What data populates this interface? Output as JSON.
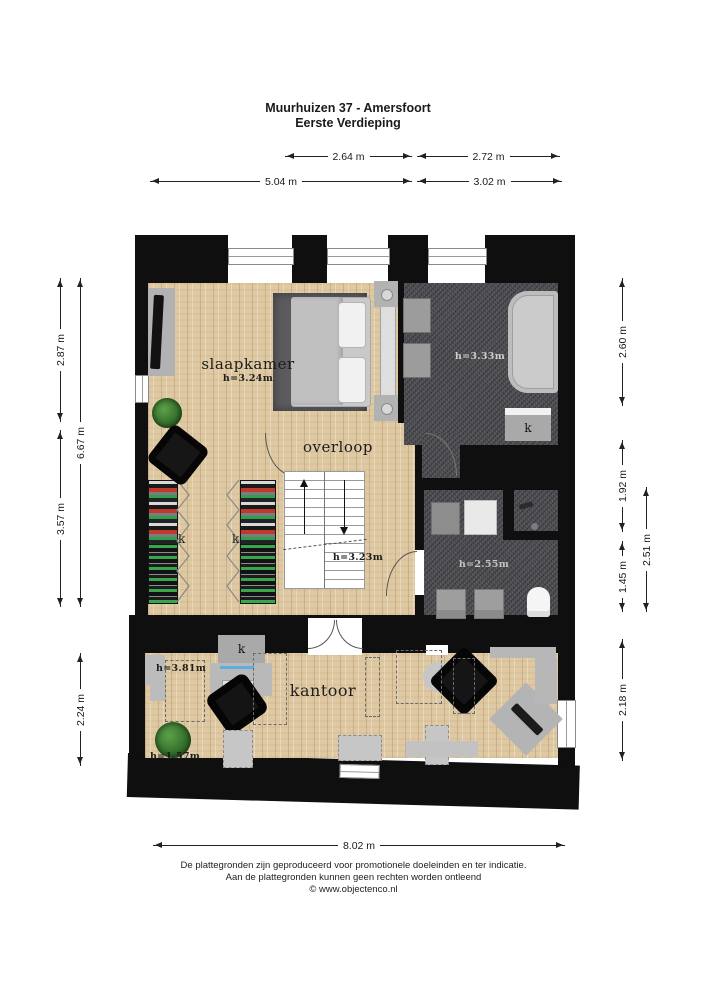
{
  "title": {
    "line1": "Muurhuizen 37 - Amersfoort",
    "line2": "Eerste Verdieping"
  },
  "dims": {
    "top_row1": [
      "2.64 m",
      "2.72 m"
    ],
    "top_row2": [
      "5.04 m",
      "3.02 m"
    ],
    "left": [
      "2.87 m",
      "6.67 m",
      "3.57 m",
      "2.24 m"
    ],
    "right": [
      "2.60 m",
      "1.92 m",
      "1.45 m",
      "2.51 m",
      "2.18 m"
    ],
    "bottom": "8.02 m"
  },
  "rooms": {
    "slaapkamer": {
      "name": "slaapkamer",
      "height": "h=3.24m"
    },
    "overloop": {
      "name": "overloop",
      "height": "h=3.23m"
    },
    "badkamer": {
      "height": "h=3.33m",
      "closet": "k"
    },
    "doucheruimte": {
      "height": "h=2.55m"
    },
    "kantoor": {
      "name": "kantoor",
      "height_back": "h=3.81m",
      "height_front": "h=1.57m",
      "closet": "k"
    },
    "garderobe": {
      "closet_left": "k",
      "closet_right": "k"
    }
  },
  "footer": {
    "line1": "De plattegronden zijn geproduceerd voor promotionele doeleinden en ter indicatie.",
    "line2": "Aan de plattegronden kunnen geen rechten worden ontleend",
    "line3": "© www.objectenco.nl"
  },
  "colors": {
    "wall": "#0f0f0f",
    "wood_floor": "#dfc9a2",
    "tile_floor": "#48484d",
    "furniture_gray": "#b2b2b2",
    "clothes_red": "#c0392b",
    "clothes_green": "#2e9e4f"
  }
}
